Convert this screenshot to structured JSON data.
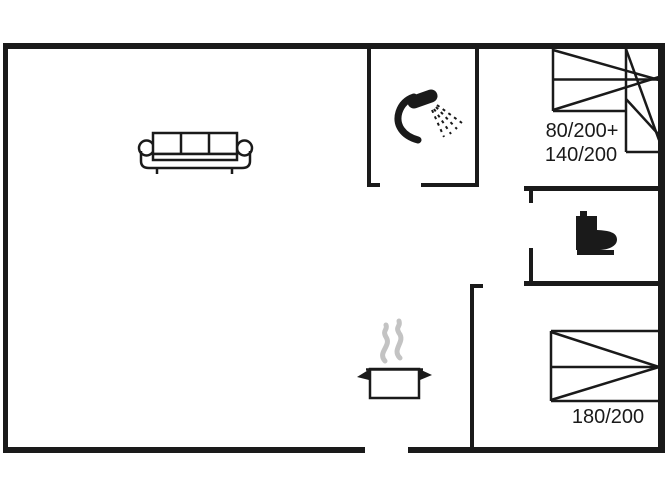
{
  "floorplan": {
    "labels": {
      "double_bed_line1": "80/200+",
      "double_bed_line2": "140/200",
      "single_bed": "180/200"
    },
    "colors": {
      "wall": "#1a1a1a",
      "steam": "#c3c3c3",
      "background": "#ffffff"
    },
    "icons": {
      "sofa": "sofa-icon",
      "shower": "shower-icon",
      "toilet": "toilet-icon",
      "cooking_pot": "cooking-pot-icon",
      "steam": "steam-icon",
      "double_bed": "double-bed-icon",
      "single_bed": "single-bed-icon"
    }
  }
}
